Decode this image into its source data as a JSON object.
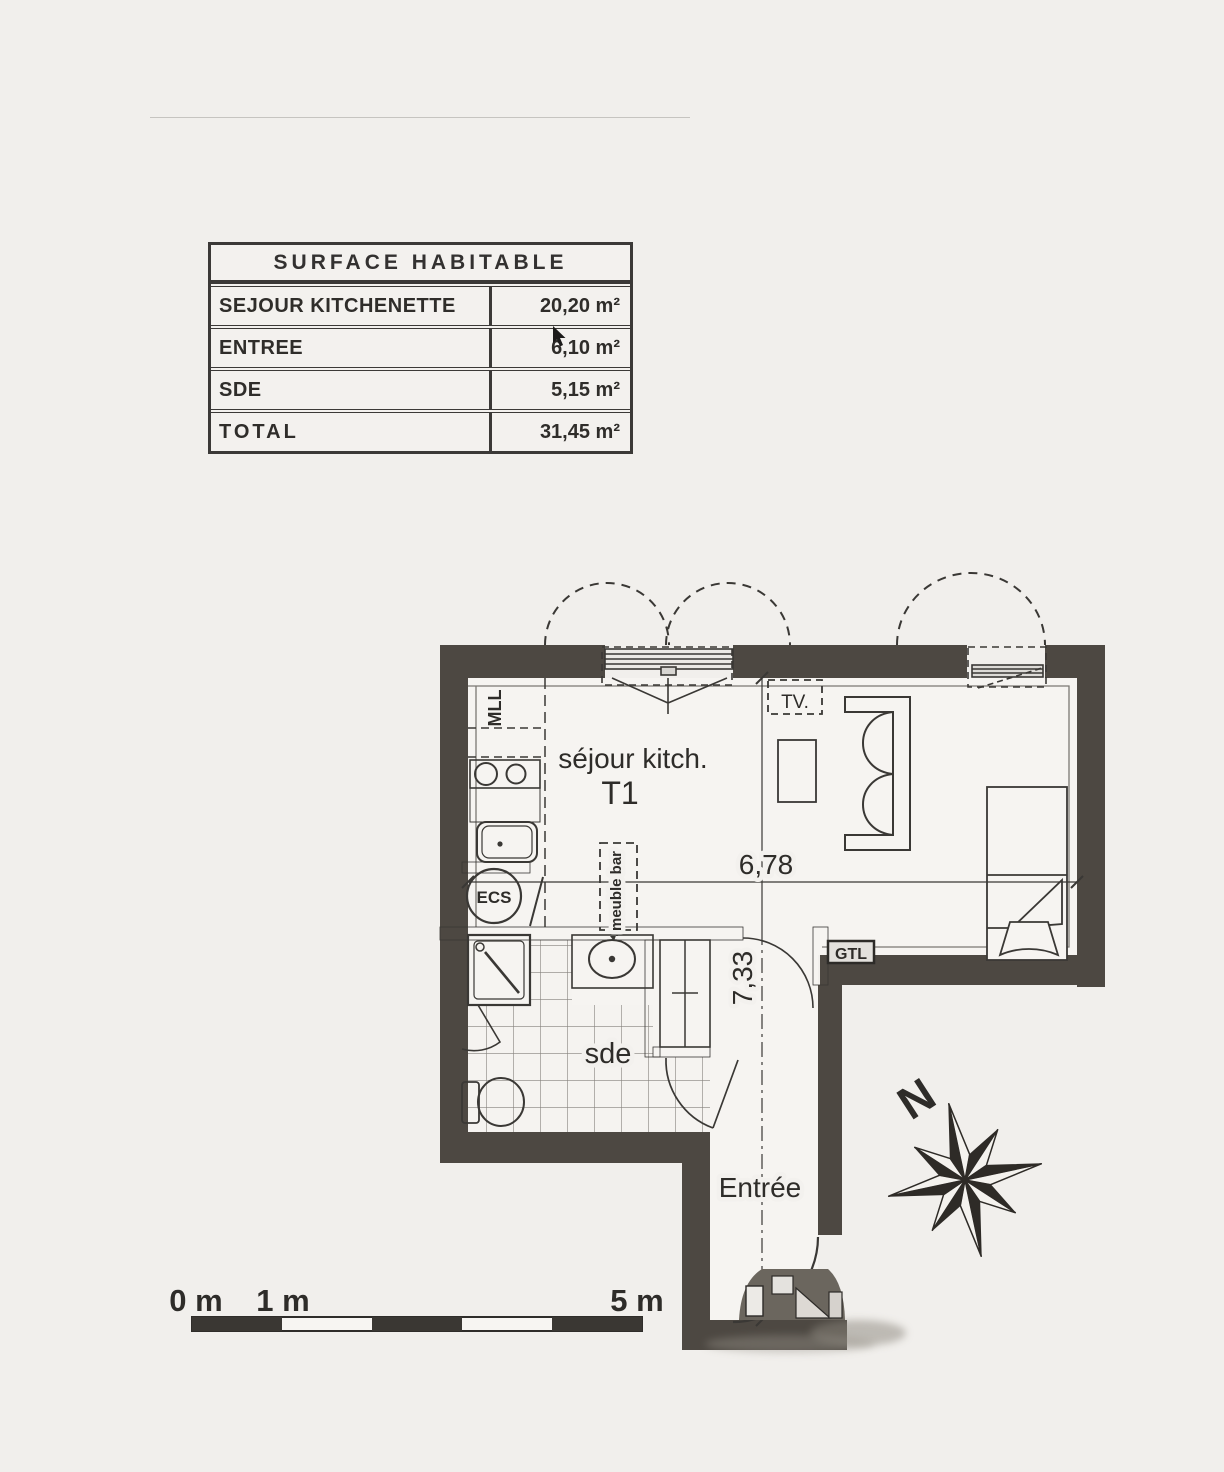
{
  "colors": {
    "paper": "#f1efec",
    "wall": "#4d4842",
    "ink": "#3a3835"
  },
  "surface_table": {
    "title": "SURFACE HABITABLE",
    "rows": [
      {
        "label": "SEJOUR KITCHENETTE",
        "value": "20,20 m²"
      },
      {
        "label": "ENTREE",
        "value": "6,10 m²"
      },
      {
        "label": "SDE",
        "value": "5,15 m²"
      }
    ],
    "total": {
      "label": "TOTAL",
      "value": "31,45 m²"
    }
  },
  "plan": {
    "room_labels": {
      "sejour": "séjour kitch.",
      "type": "T1",
      "sde": "sde",
      "entree": "Entrée"
    },
    "equipment_labels": {
      "mll": "MLL",
      "ecs": "ECS",
      "meuble_bar": "meuble bar",
      "tv": "TV.",
      "gtl": "GTL"
    },
    "dimensions": {
      "width": "6,78",
      "height": "7,33"
    },
    "compass": {
      "north": "N"
    }
  },
  "scale_bar": {
    "labels": [
      "0 m",
      "1 m",
      "5 m"
    ]
  }
}
